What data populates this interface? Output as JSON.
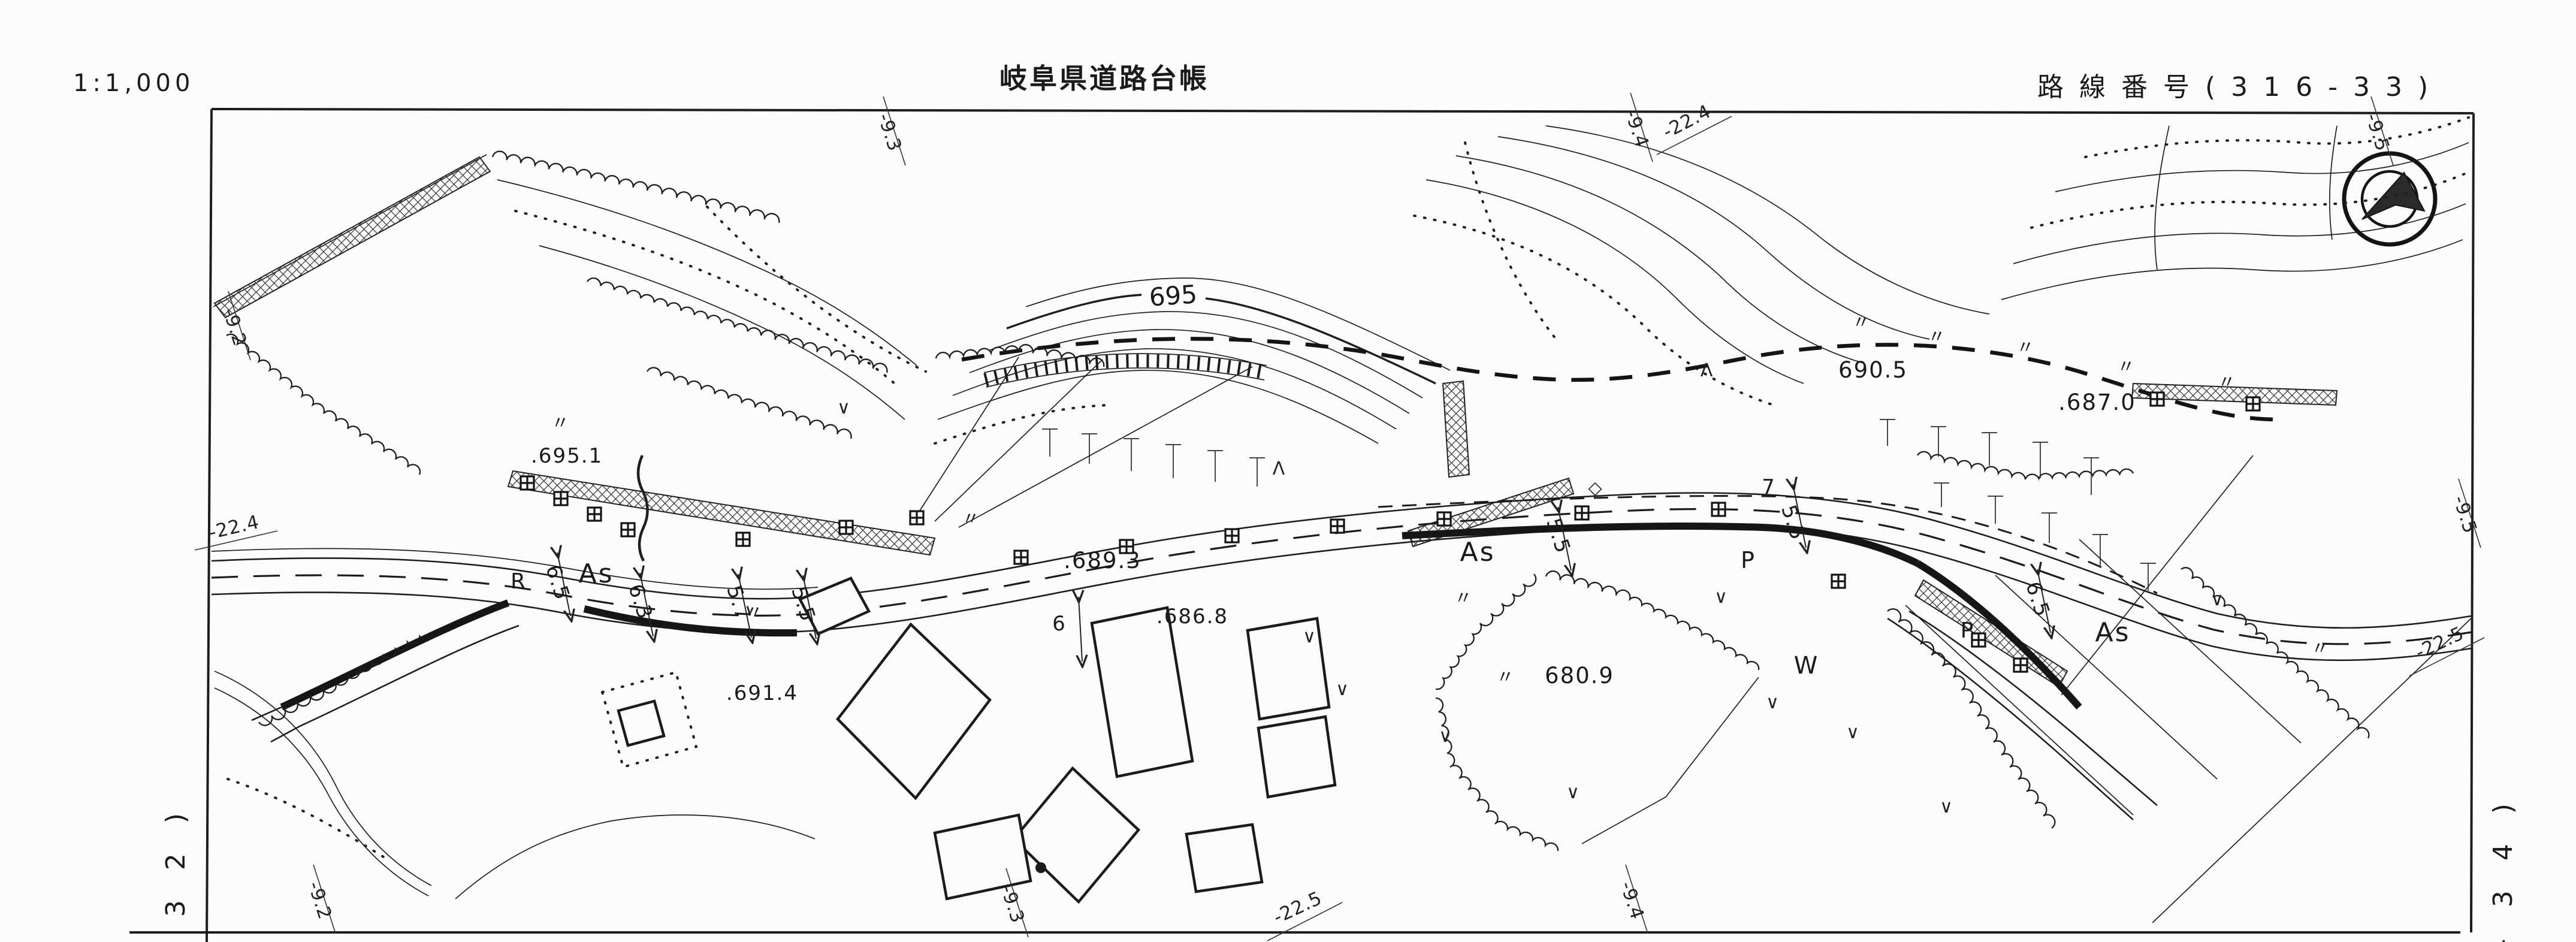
{
  "header": {
    "scale_label": "1:1,000",
    "title": "岐阜県道路台帳",
    "route_label": "路線番号(316-33)"
  },
  "compass": {
    "icon": "north-arrow-in-double-circle"
  },
  "grid_labels": {
    "top": [
      "-9.3",
      "-9.4",
      "-22.4",
      "-9.5"
    ],
    "left": [
      "-9.2",
      "-22.4"
    ],
    "right": [
      "-9.5",
      "-22.5"
    ],
    "bottom": [
      "-9.2",
      "-9.3",
      "-22.5",
      "-9.4"
    ]
  },
  "sheet_refs": {
    "left": "− 3 2 )",
    "right": "− 3 4 )"
  },
  "map": {
    "spot_elevations": [
      ".695.1",
      ".689.3",
      ".686.8",
      "680.9",
      ".691.4",
      "690.5",
      ".687.0"
    ],
    "contour_labels": [
      "695"
    ],
    "surface_labels": {
      "as1": "As",
      "as2": "As",
      "as3": "As",
      "p1": "P",
      "p2": "P",
      "r": "R",
      "w": "W"
    },
    "width_annotations": [
      "6.5",
      "6.3",
      "5.7",
      "5.5",
      "6",
      "5.5",
      "7",
      "5.5",
      "6.5"
    ],
    "symbols": {
      "grass": "∨",
      "conifer": "Λ",
      "paddy": "〃",
      "gate": "◇"
    }
  }
}
